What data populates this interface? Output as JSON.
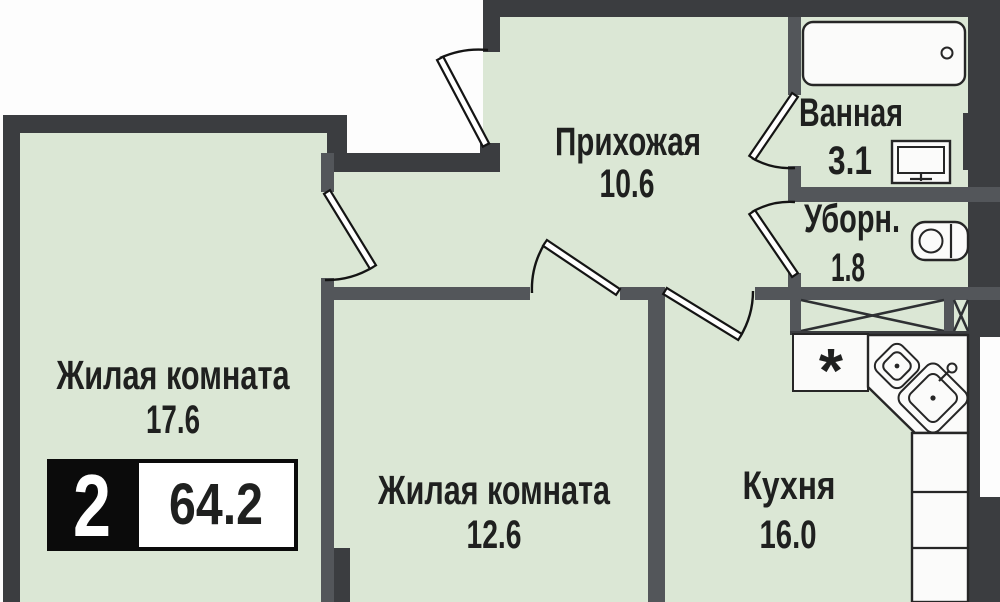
{
  "plan_type": "apartment-floor-plan",
  "badge": {
    "rooms_count": "2",
    "total_area": "64.2"
  },
  "rooms": [
    {
      "id": "hallway",
      "name": "Прихожая",
      "area": "10.6"
    },
    {
      "id": "bathroom",
      "name": "Ванная",
      "area": "3.1"
    },
    {
      "id": "toilet",
      "name": "Уборн.",
      "area": "1.8"
    },
    {
      "id": "living-room-1",
      "name": "Жилая комната",
      "area": "17.6"
    },
    {
      "id": "living-room-2",
      "name": "Жилая комната",
      "area": "12.6"
    },
    {
      "id": "kitchen",
      "name": "Кухня",
      "area": "16.0"
    }
  ],
  "symbols": {
    "stove": "*"
  },
  "colors": {
    "floor": "#dbe7d5",
    "wall_outer": "#3b3d40",
    "wall_inner": "#53565a",
    "fixture_fill": "#fbfbfa",
    "outline": "#262626",
    "badge_bg": "#0b0b0b",
    "badge_text": "#ffffff"
  }
}
